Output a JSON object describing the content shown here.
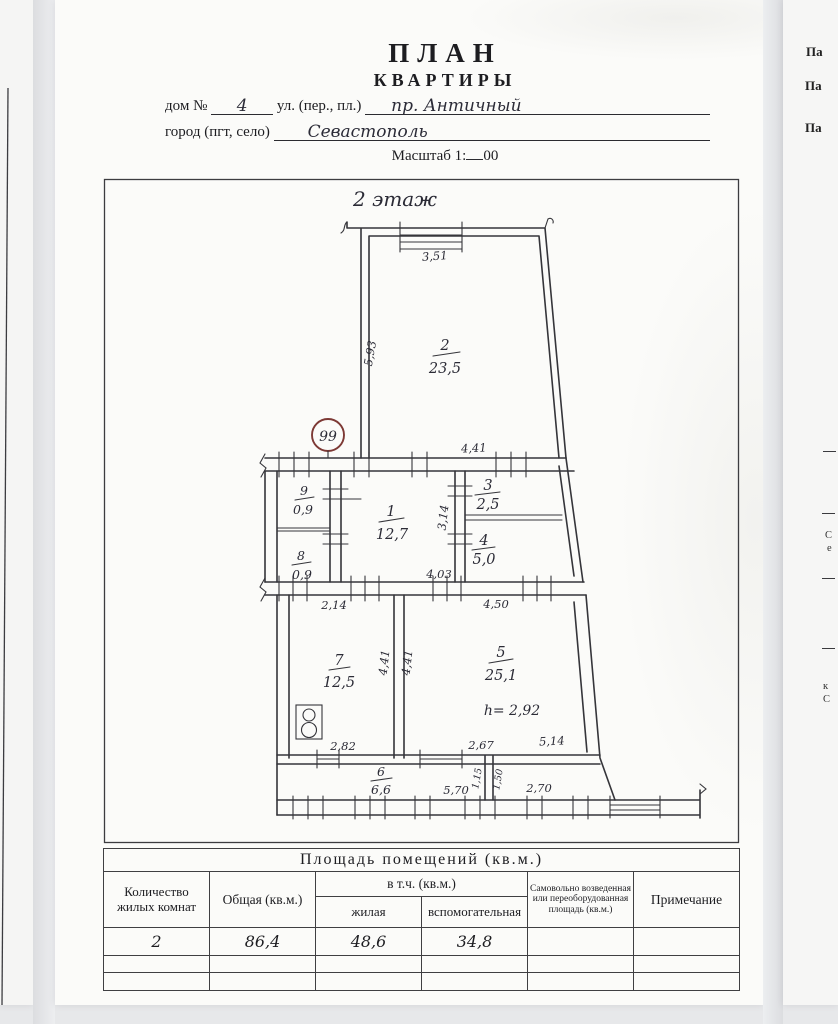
{
  "colors": {
    "stamp_red": "#7d3935",
    "ink": "#2c2c38",
    "line": "#35353a"
  },
  "header": {
    "title": "ПЛАН",
    "subtitle": "КВАРТИРЫ",
    "house_label": "дом №",
    "house_value": "4",
    "street_label": "ул. (пер., пл.)",
    "street_value": "пр. Античный",
    "city_label": "город (пгт, село)",
    "city_value": "Севастополь",
    "scale_label": "Масштаб 1:",
    "scale_value": "00"
  },
  "plan": {
    "floor_label": "2 этаж",
    "stamp_number": "99",
    "height_note": "h= 2,92",
    "rooms": {
      "r1": {
        "num": "1",
        "area": "12,7"
      },
      "r2": {
        "num": "2",
        "area": "23,5"
      },
      "r3": {
        "num": "3",
        "area": "2,5"
      },
      "r4": {
        "num": "4",
        "area": "5,0"
      },
      "r5": {
        "num": "5",
        "area": "25,1"
      },
      "r6": {
        "num": "6",
        "area": "6,6"
      },
      "r7": {
        "num": "7",
        "area": "12,5"
      },
      "r8": {
        "num": "8",
        "area": "0,9"
      },
      "r9": {
        "num": "9",
        "area": "0,9"
      }
    },
    "dims": {
      "room2_window": "3,51",
      "room2_left": "5,93",
      "room2_bottom": "4,41",
      "rooms34_left": "3,14",
      "room1_bottom": "4,03",
      "room7_top": "2,14",
      "room5_top": "4,50",
      "room7_right": "4,41",
      "room5_left": "4,41",
      "room7_bottom": "2,82",
      "room5_bottom_left": "2,67",
      "room5_bottom_right": "5,14",
      "room6_divider_left": "1,15",
      "room6_divider_right": "1,50",
      "room6_bottom": "5,70",
      "balcony_bottom": "2,70"
    }
  },
  "table": {
    "title": "Площадь помещений (кв.м.)",
    "columns": {
      "rooms_count": "Количество жилых комнат",
      "total": "Общая (кв.м.)",
      "including": "в т.ч. (кв.м.)",
      "living": "жилая",
      "auxiliary": "вспомогательная",
      "unauthorized": "Самовольно возведенная или переоборудованная площадь (кв.м.)",
      "note": "Примечание"
    },
    "values": {
      "rooms_count": "2",
      "total": "86,4",
      "living": "48,6",
      "auxiliary": "34,8",
      "unauthorized": "",
      "note": ""
    }
  },
  "right_page": {
    "line1": "Па",
    "line2": "Па",
    "line3": "Па",
    "frag1": "С",
    "frag2": "е",
    "frag3": "к",
    "frag4": "С"
  }
}
